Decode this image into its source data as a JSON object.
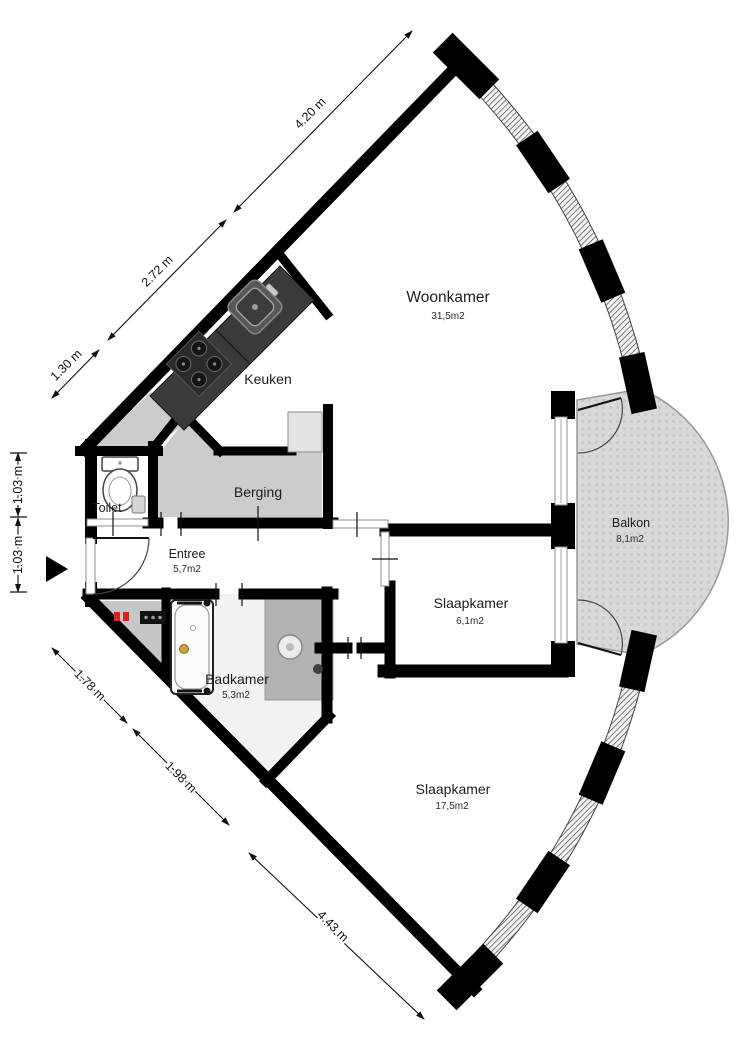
{
  "title": "Apartment floor plan",
  "rooms": {
    "woonkamer": {
      "name": "Woonkamer",
      "area": "31,5m2"
    },
    "keuken": {
      "name": "Keuken"
    },
    "berging": {
      "name": "Berging"
    },
    "toilet": {
      "name": "Toilet"
    },
    "entree": {
      "name": "Entree",
      "area": "5,7m2"
    },
    "badkamer": {
      "name": "Badkamer",
      "area": "5,3m2"
    },
    "slaapkamer_1": {
      "name": "Slaapkamer",
      "area": "6,1m2"
    },
    "slaapkamer_2": {
      "name": "Slaapkamer",
      "area": "17,5m2"
    },
    "balkon": {
      "name": "Balkon",
      "area": "8,1m2"
    }
  },
  "dimensions": {
    "top_edge": [
      {
        "label": "4.20 m"
      },
      {
        "label": "2.72 m"
      },
      {
        "label": "1.30 m"
      }
    ],
    "left_edge": [
      {
        "label": "1.03 m"
      },
      {
        "label": "1.03 m"
      }
    ],
    "bottom_edge": [
      {
        "label": "1.78 m"
      },
      {
        "label": "1.98 m"
      },
      {
        "label": "4.43 m"
      }
    ]
  },
  "colors": {
    "wall": "#000000",
    "storage_floor": "#cccccc",
    "bathroom_floor": "#f2f2f2",
    "shower_floor": "#b3b3b3",
    "balcony_floor": "#d9d9d9",
    "counter": "#3a3a3a",
    "hookup_red": "#cc2a1e"
  }
}
